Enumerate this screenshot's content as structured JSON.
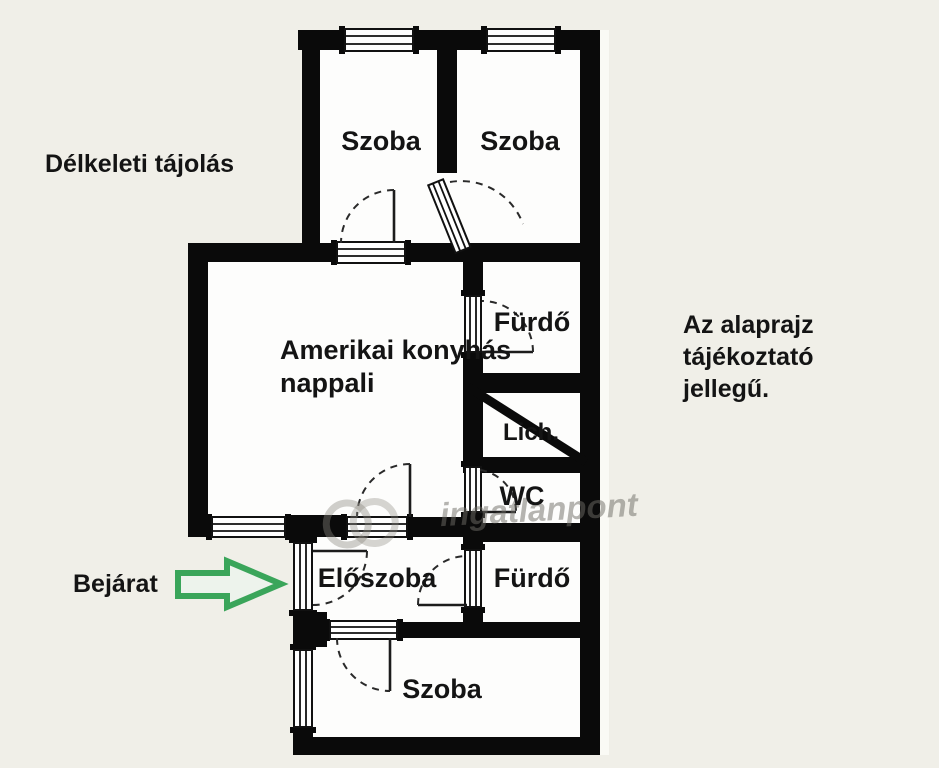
{
  "page": {
    "kind": "apartment floor plan drawing"
  },
  "colors": {
    "background": "#f0efe8",
    "wall": "#0a0a0a",
    "room_fill": "#fdfdfc",
    "arrow_green": "#3aa55a",
    "watermark_gray": "#6f6d66",
    "label_text": "#141414"
  },
  "annotations": {
    "orientation": "Délkeleti tájolás",
    "entrance_label": "Bejárat",
    "disclaimer": {
      "line1": "Az alaprajz",
      "line2": "tájékoztató",
      "line3": "jellegű."
    }
  },
  "rooms": {
    "szoba_top_left": {
      "label": "Szoba"
    },
    "szoba_top_right": {
      "label": "Szoba"
    },
    "nappali": {
      "line1": "Amerikai konyhás",
      "line2": "nappali"
    },
    "furdo_upper": {
      "label": "Fürdő"
    },
    "lich": {
      "label": "Lich."
    },
    "wc": {
      "label": "WC"
    },
    "eloszoba": {
      "label": "Előszoba"
    },
    "furdo_lower": {
      "label": "Fürdő"
    },
    "szoba_bottom": {
      "label": "Szoba"
    }
  },
  "watermark": {
    "text": "ingatlanpont"
  }
}
